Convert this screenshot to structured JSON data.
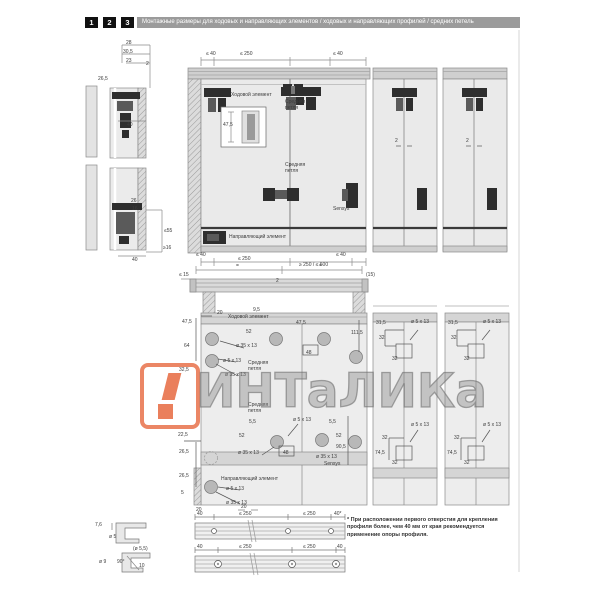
{
  "header": {
    "steps": [
      "1",
      "2",
      "3"
    ],
    "title": "Монтажные размеры для ходовых и направляющих элементов / ходовых и направляющих профилей / средних петель"
  },
  "watermark": {
    "text": "ИНТаЛИКа",
    "accent_color": "#e8714a"
  },
  "component_labels": {
    "running_element": "Ходовой элемент",
    "middle_hinge": "Средняя петля",
    "sensys": "Sensys",
    "guiding_element": "Направляющий элемент"
  },
  "dims": {
    "d28": "28",
    "d30_5": "30,5",
    "d23": "23",
    "d2": "2",
    "d26_5": "26,5",
    "d40": "40",
    "d26": "26",
    "d16": "16",
    "le55": "≤55",
    "ge16": "≥16",
    "le40": "≤ 40",
    "le250": "≤ 250",
    "range_250_600": "≥ 250 / ≤ 600",
    "le15": "≤ 15",
    "par15": "(15)",
    "eq": "=",
    "d47_5": "47,5",
    "d20": "20",
    "d9_5": "9,5",
    "d52": "52",
    "d64": "64",
    "d111_5": "111,5",
    "d48": "48",
    "d32_5": "32,5",
    "d5_5": "5,5",
    "d90_5": "90,5",
    "d22_5": "22,5",
    "d5": "5",
    "d31_5": "31,5",
    "d32": "32",
    "d74_5": "74,5",
    "cup35": "ø 35 x 13",
    "hole5": "ø 5 x 13",
    "d7_6": "7,6",
    "dia5": "ø 5",
    "dia5_5": "(ø 5,5)",
    "dia9": "ø 9",
    "deg90": "90°",
    "d10": "10",
    "d40star": "40*"
  },
  "footnote": "* При расположении первого отверстия для крепления профиля более, чем 40 мм от края рекомендуется применение опоры профиля."
}
